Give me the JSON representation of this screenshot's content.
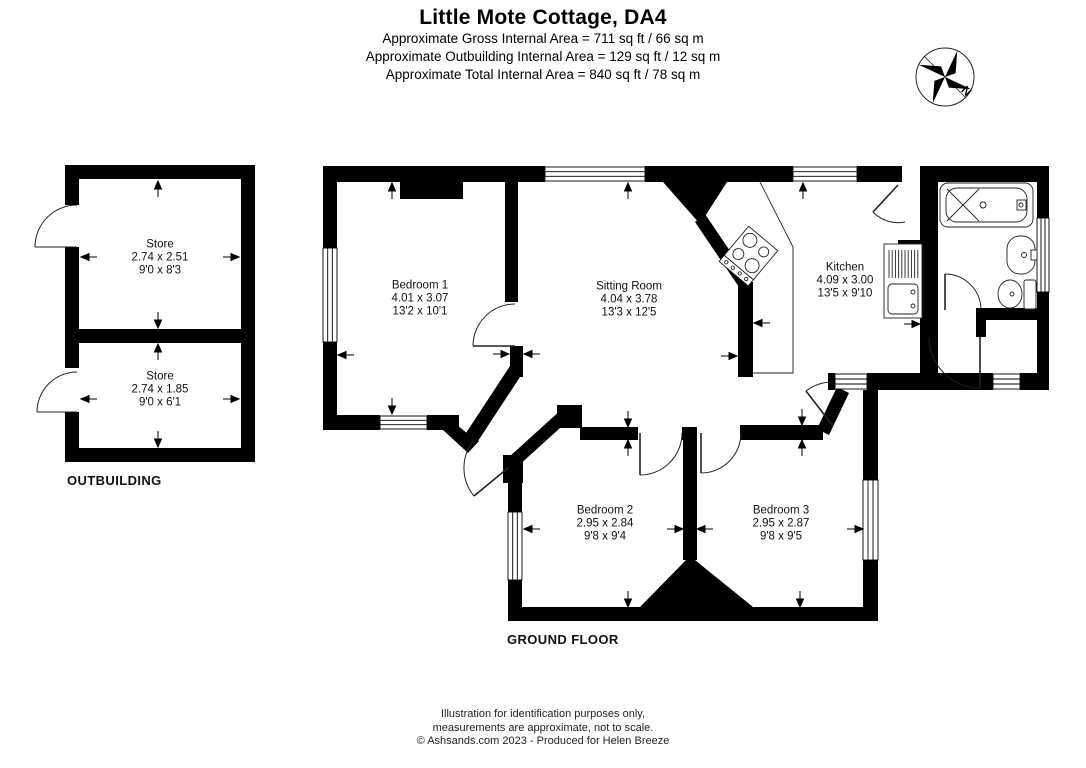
{
  "header": {
    "title": "Little Mote Cottage, DA4",
    "lines": [
      "Approximate Gross Internal Area = 711 sq ft / 66 sq m",
      "Approximate Outbuilding Internal Area = 129 sq ft / 12 sq m",
      "Approximate Total Internal Area = 840 sq ft / 78 sq m"
    ]
  },
  "compass": {
    "label": "N"
  },
  "outbuilding": {
    "label": "OUTBUILDING",
    "rooms": [
      {
        "name": "Store",
        "metric": "2.74 x 2.51",
        "imperial": "9'0 x 8'3"
      },
      {
        "name": "Store",
        "metric": "2.74 x 1.85",
        "imperial": "9'0 x 6'1"
      }
    ]
  },
  "ground_floor": {
    "label": "GROUND FLOOR",
    "rooms": [
      {
        "name": "Bedroom 1",
        "metric": "4.01 x 3.07",
        "imperial": "13'2 x 10'1"
      },
      {
        "name": "Sitting Room",
        "metric": "4.04 x 3.78",
        "imperial": "13'3 x 12'5"
      },
      {
        "name": "Kitchen",
        "metric": "4.09 x 3.00",
        "imperial": "13'5 x 9'10"
      },
      {
        "name": "Bedroom 2",
        "metric": "2.95 x 2.84",
        "imperial": "9'8 x 9'4"
      },
      {
        "name": "Bedroom 3",
        "metric": "2.95 x 2.87",
        "imperial": "9'8 x 9'5"
      }
    ]
  },
  "footer": {
    "lines": [
      "Illustration for identification purposes only,",
      "measurements are approximate, not to scale.",
      "© Ashsands.com 2023 - Produced for Helen Breeze"
    ]
  },
  "colors": {
    "wall": "#000000",
    "background": "#ffffff",
    "thin_line": "#222222"
  }
}
